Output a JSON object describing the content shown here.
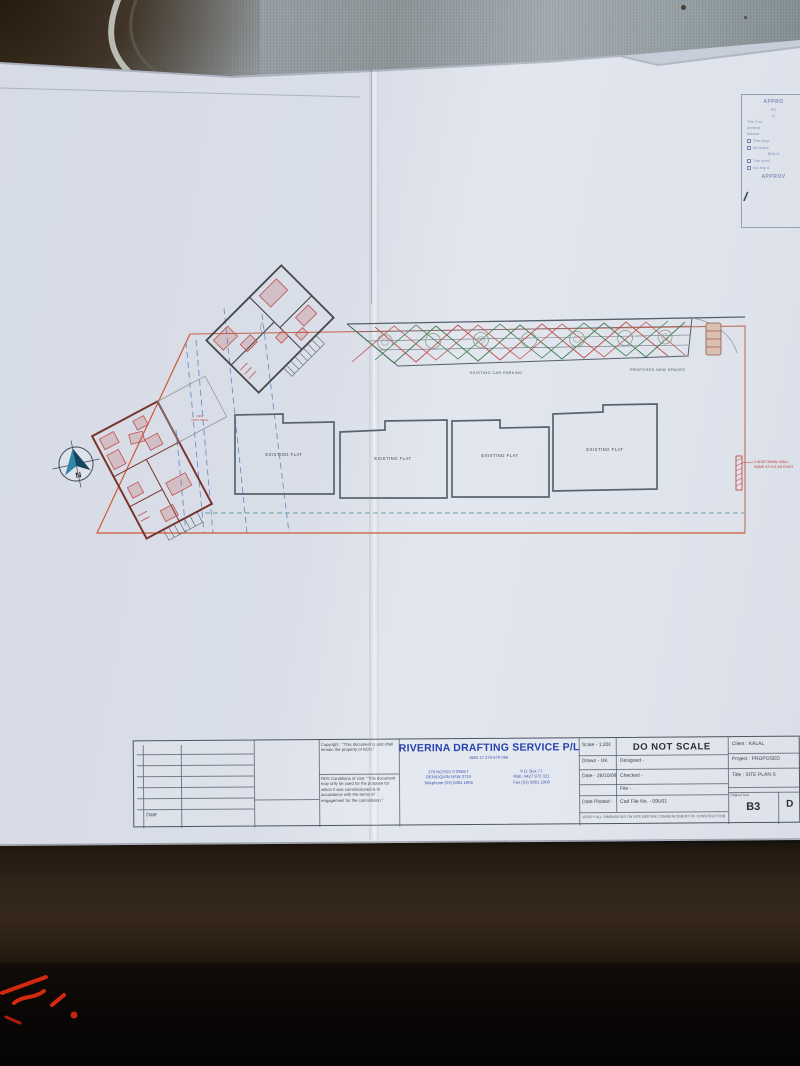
{
  "colors": {
    "company_blue": "#2743ae",
    "plan_red": "#c0504d",
    "plan_green": "#3f7d52",
    "boundary_red": "#c4604a",
    "driveway_blue": "#4f7fc2",
    "note_red": "#c0392b"
  },
  "stamp": {
    "lines": [
      "APPRO",
      "PO",
      "D",
      "The Cou",
      "underst",
      "follows",
      "The requ",
      "No inspe",
      "BUILD",
      "The nomi",
      "No any d",
      "APPROV"
    ]
  },
  "plan": {
    "north": "N",
    "flat_label": "EXISTING FLAT",
    "parking_left": "EXISTING CAR PARKING",
    "parking_right": "PROPOSED NEW SPACES",
    "note1": "2 ADDITIONAL WALL",
    "note2": "SAME STYLE AS EXIST",
    "house_note1": "NEW",
    "house_note2": "PRVT SPCE"
  },
  "titleblock": {
    "date_label": "Date",
    "copyright": "Copyright : \"This document is and shall remain the property of RDS.\"",
    "conditions": "RDS Conditions of Use: \"This document may only be used for the purpose for which it was commissioned & in accordance with the terms of engagement for the commission.\"",
    "company": "RIVERINA DRAFTING SERVICE P/L",
    "abn": "ABN 17 274 679 066",
    "address_1": "275 NOYES STREET",
    "address_2": "DENILIQUIN NSW 2710",
    "address_3": "Telephone (03) 5881 1906",
    "po": "P.O. Box 77",
    "mob": "Mob. 0427 972 321",
    "fax": "Fax (03) 5881 1906",
    "scale": "Scale - 1:200",
    "do_not_scale": "DO NOT SCALE",
    "drawn": "Drawn - UK",
    "designed": "Designed -",
    "date": "Date - 28/10/09",
    "checked": "Checked -",
    "file": "File -",
    "date_plotted": "Date Plotted -",
    "cad_file": "Cad File No. - 09U01",
    "client": "Client : KALAL",
    "project": "Project :  PROPOSED",
    "title": "Title : SITE PLAN S",
    "original_size_label": "Original Size",
    "original_size": "B3",
    "drawing_label": "D",
    "disclaimer": "VERIFY ALL DIMENSIONS ON SITE BEFORE COMMENCEMENT OF CONSTRUCTION"
  }
}
